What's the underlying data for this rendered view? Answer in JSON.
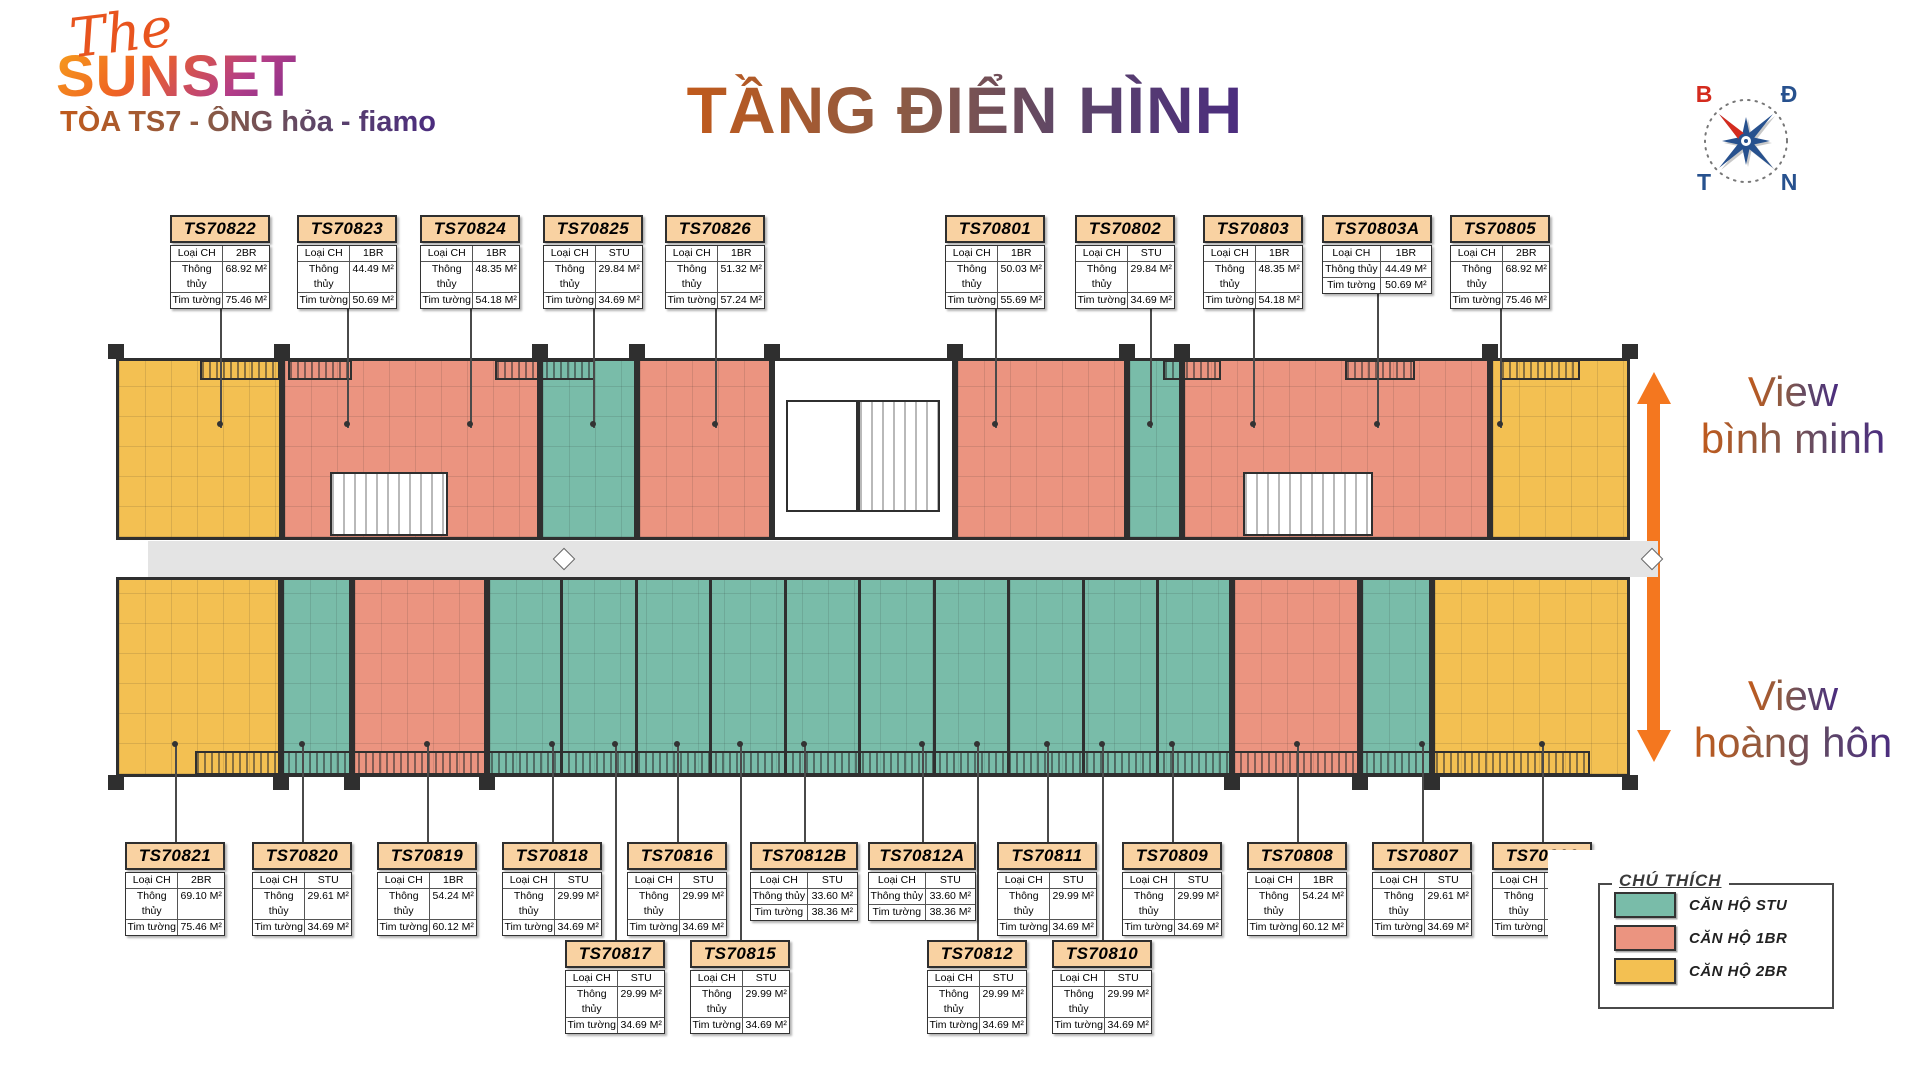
{
  "logo": {
    "the": "The",
    "name": "SUNSET",
    "tagline": "TÒA TS7 -  ÔNG hỏa - fiamo"
  },
  "title": "TẦNG ĐIỂN HÌNH",
  "compass": {
    "n": "B",
    "e": "Đ",
    "w": "T",
    "s": "N"
  },
  "views": {
    "top": {
      "line1": "View",
      "line2": "bình minh"
    },
    "bottom": {
      "line1": "View",
      "line2": "hoàng hôn"
    }
  },
  "card_labels": {
    "type": "Loại CH",
    "clear": "Thông thủy",
    "wall": "Tim tường"
  },
  "cards_top": [
    {
      "id": "TS70822",
      "type": "2BR",
      "clear": "68.92 M²",
      "wall": "75.46 M²",
      "x": 170
    },
    {
      "id": "TS70823",
      "type": "1BR",
      "clear": "44.49 M²",
      "wall": "50.69 M²",
      "x": 297
    },
    {
      "id": "TS70824",
      "type": "1BR",
      "clear": "48.35 M²",
      "wall": "54.18 M²",
      "x": 420
    },
    {
      "id": "TS70825",
      "type": "STU",
      "clear": "29.84 M²",
      "wall": "34.69 M²",
      "x": 543
    },
    {
      "id": "TS70826",
      "type": "1BR",
      "clear": "51.32 M²",
      "wall": "57.24 M²",
      "x": 665
    },
    {
      "id": "TS70801",
      "type": "1BR",
      "clear": "50.03 M²",
      "wall": "55.69 M²",
      "x": 945
    },
    {
      "id": "TS70802",
      "type": "STU",
      "clear": "29.84 M²",
      "wall": "34.69 M²",
      "x": 1075,
      "sx": 1150
    },
    {
      "id": "TS70803",
      "type": "1BR",
      "clear": "48.35 M²",
      "wall": "54.18 M²",
      "x": 1203
    },
    {
      "id": "TS70803A",
      "type": "1BR",
      "clear": "44.49 M²",
      "wall": "50.69 M²",
      "x": 1322,
      "w": 110
    },
    {
      "id": "TS70805",
      "type": "2BR",
      "clear": "68.92 M²",
      "wall": "75.46 M²",
      "x": 1450
    }
  ],
  "cards_bottom": [
    {
      "id": "TS70821",
      "type": "2BR",
      "clear": "69.10 M²",
      "wall": "75.46 M²",
      "x": 125
    },
    {
      "id": "TS70820",
      "type": "STU",
      "clear": "29.61 M²",
      "wall": "34.69 M²",
      "x": 252
    },
    {
      "id": "TS70819",
      "type": "1BR",
      "clear": "54.24 M²",
      "wall": "60.12 M²",
      "x": 377
    },
    {
      "id": "TS70818",
      "type": "STU",
      "clear": "29.99 M²",
      "wall": "34.69 M²",
      "x": 502
    },
    {
      "id": "TS70816",
      "type": "STU",
      "clear": "29.99 M²",
      "wall": "34.69 M²",
      "x": 627
    },
    {
      "id": "TS70812B",
      "type": "STU",
      "clear": "33.60 M²",
      "wall": "38.36 M²",
      "x": 750,
      "w": 108
    },
    {
      "id": "TS70812A",
      "type": "STU",
      "clear": "33.60 M²",
      "wall": "38.36 M²",
      "x": 868,
      "w": 108
    },
    {
      "id": "TS70811",
      "type": "STU",
      "clear": "29.99 M²",
      "wall": "34.69 M²",
      "x": 997
    },
    {
      "id": "TS70809",
      "type": "STU",
      "clear": "29.99 M²",
      "wall": "34.69 M²",
      "x": 1122
    },
    {
      "id": "TS70808",
      "type": "1BR",
      "clear": "54.24 M²",
      "wall": "60.12 M²",
      "x": 1247
    },
    {
      "id": "TS70807",
      "type": "STU",
      "clear": "29.61 M²",
      "wall": "34.69 M²",
      "x": 1372
    },
    {
      "id": "TS70806",
      "type": "2BR",
      "clear": "69.10 M²",
      "wall": "75.46 M²",
      "x": 1492
    }
  ],
  "cards_bottom2": [
    {
      "id": "TS70817",
      "type": "STU",
      "clear": "29.99 M²",
      "wall": "34.69 M²",
      "x": 565
    },
    {
      "id": "TS70815",
      "type": "STU",
      "clear": "29.99 M²",
      "wall": "34.69 M²",
      "x": 690
    },
    {
      "id": "TS70812",
      "type": "STU",
      "clear": "29.99 M²",
      "wall": "34.69 M²",
      "x": 927
    },
    {
      "id": "TS70810",
      "type": "STU",
      "clear": "29.99 M²",
      "wall": "34.69 M²",
      "x": 1052
    }
  ],
  "legend": {
    "title": "CHÚ THÍCH",
    "items": [
      {
        "label": "CĂN HỘ STU",
        "color": "#79bca9"
      },
      {
        "label": "CĂN HỘ 1BR",
        "color": "#eb9480"
      },
      {
        "label": "CĂN HỘ 2BR",
        "color": "#f3c052"
      }
    ]
  },
  "colors": {
    "stu": "#79bca9",
    "one_br": "#eb9480",
    "two_br": "#f3c052",
    "wall": "#2f2f2f",
    "corridor": "#e4e4e4",
    "arrow_orange": "#f4771f",
    "card_header": "#f9d2a2"
  },
  "plan": {
    "wings": [
      {
        "y": 358,
        "h": 182,
        "edge": "top",
        "units": [
          {
            "x": 116,
            "w": 166,
            "c": "y"
          },
          {
            "x": 282,
            "w": 258,
            "c": "s"
          },
          {
            "x": 540,
            "w": 97,
            "c": "t"
          },
          {
            "x": 637,
            "w": 135,
            "c": "s"
          },
          {
            "x": 772,
            "w": 183,
            "c": "w"
          },
          {
            "x": 955,
            "w": 172,
            "c": "s"
          },
          {
            "x": 1127,
            "w": 55,
            "c": "t"
          },
          {
            "x": 1182,
            "w": 308,
            "c": "s"
          },
          {
            "x": 1490,
            "w": 140,
            "c": "y"
          }
        ]
      },
      {
        "y": 577,
        "h": 200,
        "edge": "bottom",
        "units": [
          {
            "x": 116,
            "w": 165,
            "c": "y"
          },
          {
            "x": 281,
            "w": 71,
            "c": "t"
          },
          {
            "x": 352,
            "w": 135,
            "c": "s"
          },
          {
            "x": 487,
            "w": 745,
            "c": "t",
            "parts": 10
          },
          {
            "x": 1232,
            "w": 128,
            "c": "s"
          },
          {
            "x": 1360,
            "w": 72,
            "c": "t"
          },
          {
            "x": 1432,
            "w": 198,
            "c": "y"
          }
        ]
      }
    ],
    "balconies": [
      {
        "x": 200,
        "y": 360,
        "w": 80
      },
      {
        "x": 288,
        "y": 360,
        "w": 64
      },
      {
        "x": 495,
        "y": 360,
        "w": 100
      },
      {
        "x": 1163,
        "y": 360,
        "w": 58
      },
      {
        "x": 1345,
        "y": 360,
        "w": 70
      },
      {
        "x": 1500,
        "y": 360,
        "w": 80
      },
      {
        "x": 195,
        "y": 751,
        "w": 1395,
        "h": 24
      }
    ],
    "overlays": [
      {
        "t": "stairs",
        "x": 330,
        "y": 472,
        "w": 118,
        "h": 64
      },
      {
        "t": "stairs",
        "x": 1243,
        "y": 472,
        "w": 130,
        "h": 64
      },
      {
        "t": "room",
        "x": 786,
        "y": 400,
        "w": 72,
        "h": 112
      },
      {
        "t": "stairs",
        "x": 858,
        "y": 400,
        "w": 82,
        "h": 112
      }
    ]
  }
}
